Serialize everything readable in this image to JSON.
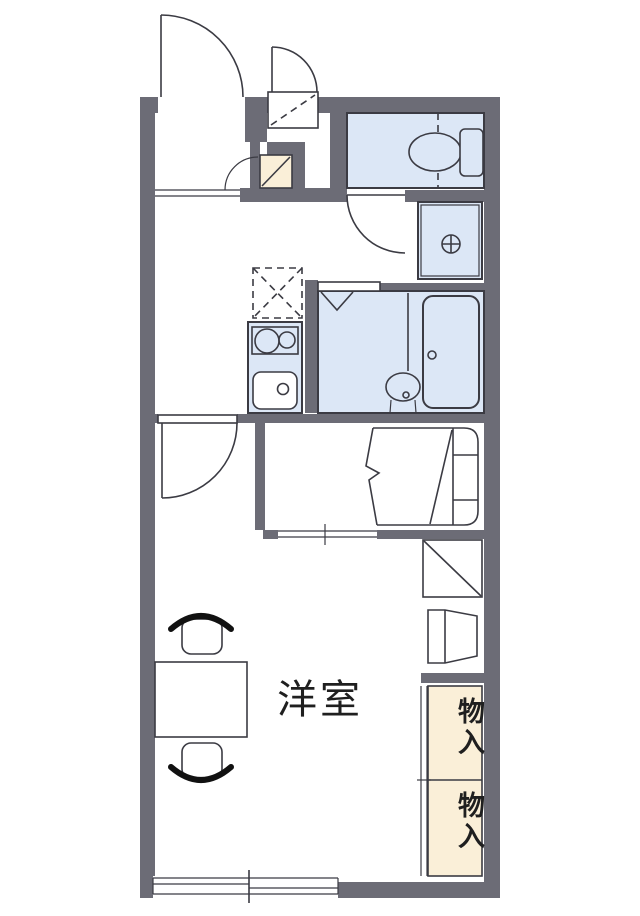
{
  "title": "1K apartment floor plan",
  "labels": {
    "western_room": "洋室",
    "storage_upper": "物入",
    "storage_lower": "物入"
  },
  "colors": {
    "wall": "#6c6c76",
    "line": "#3b3b43",
    "wet_area_fill": "#dce7f6",
    "storage_fill": "#faefd8",
    "text": "#1f1f1f",
    "background": "#ffffff"
  },
  "fixtures": [
    "entrance-door",
    "outdoor-storage-door",
    "shoe-cabinet",
    "toilet",
    "toilet-door",
    "washing-machine-pan",
    "drain-symbol",
    "refrigerator-space",
    "stove",
    "kitchen-sink",
    "bathroom-folding-door",
    "washbasin",
    "bathtub",
    "bedroom-door",
    "bed",
    "shelf-unit",
    "cabinet",
    "storage-closet",
    "sliding-window",
    "table",
    "chair"
  ]
}
